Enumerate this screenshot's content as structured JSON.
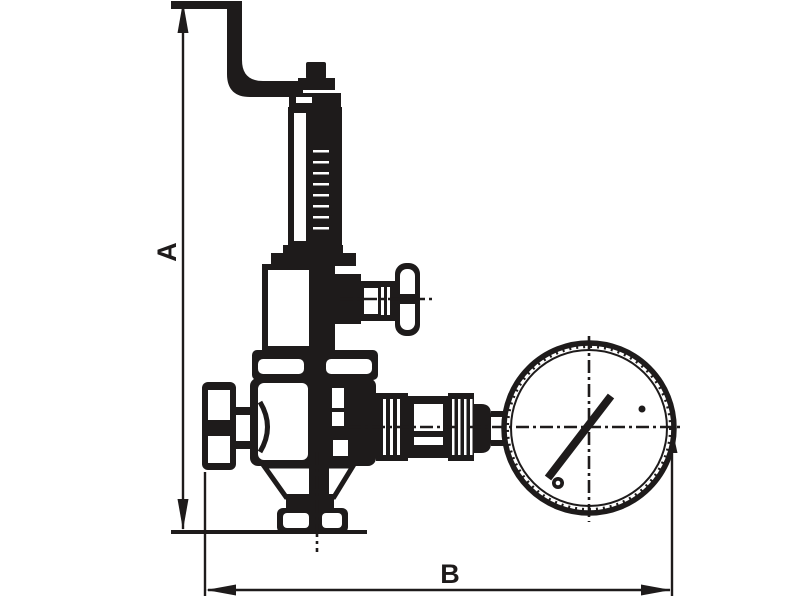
{
  "page": {
    "background_color": "#ffffff",
    "drawing_color": "#1e1b1b"
  },
  "diagram": {
    "type": "technical-line-drawing",
    "subject": "Relief valve with bent discharge pipe, spring housing, T-handle fitting, inlet cap, bottom outlet flange and pressure gauge",
    "dimensions": [
      {
        "label": "A",
        "orientation": "vertical",
        "span": "from top of bent pipe down to outlet flange base"
      },
      {
        "label": "B",
        "orientation": "horizontal",
        "span": "from left inlet cap to right edge of pressure gauge"
      }
    ],
    "components": [
      "bent-discharge-pipe",
      "bonnet-nut",
      "spring-housing",
      "yoke-frame",
      "t-handle-fitting",
      "upper-flange-block",
      "valve-body",
      "inlet-cap",
      "gauge-connector",
      "pressure-gauge",
      "gauge-needle",
      "bottom-outlet-flange"
    ]
  }
}
